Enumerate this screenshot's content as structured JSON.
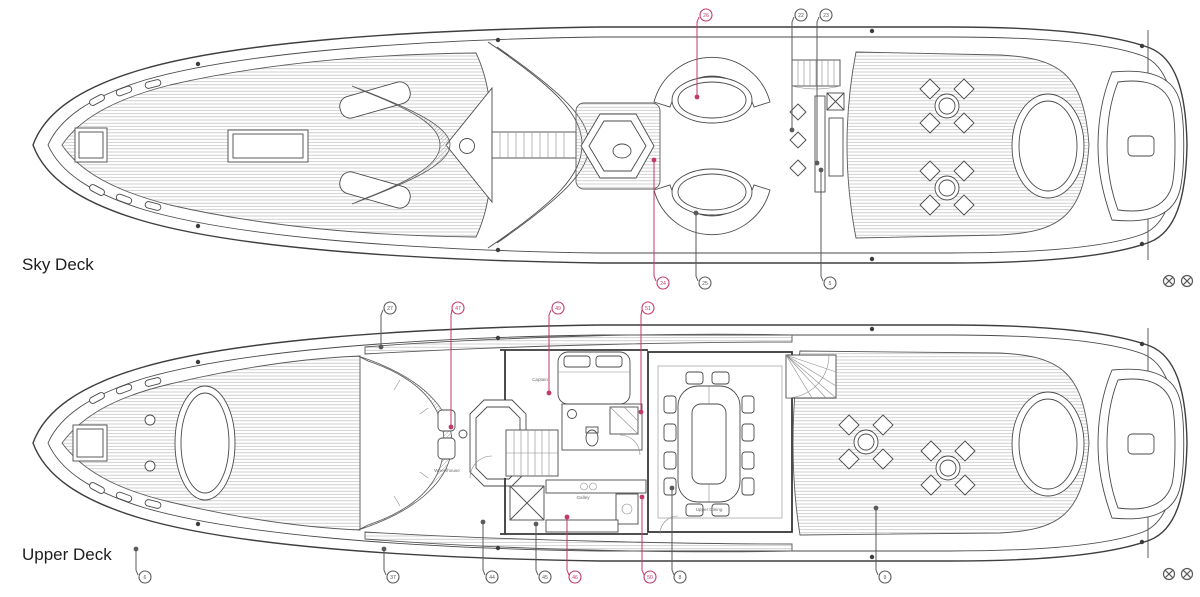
{
  "page": {
    "background": "#ffffff",
    "width": 1200,
    "height": 597
  },
  "colors": {
    "line": "#454545",
    "accent": "#c43a66",
    "callout_gray": "#5a5a5a",
    "deck_label": "#1d1d1d",
    "room_label": "#6a6a6a"
  },
  "decks": {
    "sky": {
      "label": "Sky Deck"
    },
    "upper": {
      "label": "Upper Deck",
      "rooms": {
        "wheelhouse": "Wheelhouse",
        "captain": "Captain",
        "galley": "Galley",
        "dining": "Upper Dining"
      }
    }
  },
  "callouts": [
    {
      "label": "26",
      "color": "red",
      "circle": [
        706,
        15
      ],
      "leader": [
        [
          699,
          17
        ],
        [
          697,
          22
        ],
        [
          697,
          95
        ]
      ],
      "dot": [
        697,
        97
      ]
    },
    {
      "label": "22",
      "color": "gray",
      "circle": [
        801,
        15
      ],
      "leader": [
        [
          794,
          17
        ],
        [
          792,
          22
        ],
        [
          792,
          128
        ]
      ],
      "dot": [
        792,
        130
      ]
    },
    {
      "label": "23",
      "color": "gray",
      "circle": [
        826,
        15
      ],
      "leader": [
        [
          819,
          17
        ],
        [
          817,
          22
        ],
        [
          817,
          161
        ]
      ],
      "dot": [
        817,
        163
      ]
    },
    {
      "label": "24",
      "color": "red",
      "circle": [
        663,
        283
      ],
      "leader": [
        [
          656,
          281
        ],
        [
          654,
          276
        ],
        [
          654,
          162
        ]
      ],
      "dot": [
        654,
        160
      ]
    },
    {
      "label": "25",
      "color": "gray",
      "circle": [
        705,
        283
      ],
      "leader": [
        [
          698,
          281
        ],
        [
          696,
          276
        ],
        [
          696,
          215
        ]
      ],
      "dot": [
        696,
        213
      ]
    },
    {
      "label": "5",
      "color": "gray",
      "circle": [
        830,
        283
      ],
      "leader": [
        [
          823,
          281
        ],
        [
          821,
          276
        ],
        [
          821,
          172
        ]
      ],
      "dot": [
        821,
        170
      ]
    },
    {
      "label": "27",
      "color": "gray",
      "circle": [
        390,
        308
      ],
      "leader": [
        [
          383,
          310
        ],
        [
          381,
          315
        ],
        [
          381,
          345
        ]
      ],
      "dot": [
        381,
        347
      ]
    },
    {
      "label": "47",
      "color": "red",
      "circle": [
        458,
        308
      ],
      "leader": [
        [
          452,
          310
        ],
        [
          451,
          315
        ],
        [
          451,
          425
        ]
      ],
      "dot": [
        451,
        427
      ]
    },
    {
      "label": "49",
      "color": "red",
      "circle": [
        558,
        308
      ],
      "leader": [
        [
          551,
          310
        ],
        [
          549,
          315
        ],
        [
          549,
          391
        ]
      ],
      "dot": [
        549,
        393
      ]
    },
    {
      "label": "51",
      "color": "red",
      "circle": [
        648,
        308
      ],
      "leader": [
        [
          642,
          310
        ],
        [
          641,
          315
        ],
        [
          641,
          410
        ]
      ],
      "dot": [
        641,
        412
      ]
    },
    {
      "label": "6",
      "color": "gray",
      "circle": [
        145,
        577
      ],
      "leader": [
        [
          138,
          575
        ],
        [
          136,
          570
        ],
        [
          136,
          551
        ]
      ],
      "dot": [
        136,
        549
      ]
    },
    {
      "label": "37",
      "color": "gray",
      "circle": [
        393,
        577
      ],
      "leader": [
        [
          386,
          575
        ],
        [
          384,
          570
        ],
        [
          384,
          551
        ]
      ],
      "dot": [
        384,
        549
      ]
    },
    {
      "label": "44",
      "color": "gray",
      "circle": [
        492,
        577
      ],
      "leader": [
        [
          485,
          575
        ],
        [
          483,
          570
        ],
        [
          483,
          524
        ]
      ],
      "dot": [
        483,
        522
      ]
    },
    {
      "label": "45",
      "color": "gray",
      "circle": [
        545,
        577
      ],
      "leader": [
        [
          538,
          575
        ],
        [
          536,
          570
        ],
        [
          536,
          526
        ]
      ],
      "dot": [
        536,
        524
      ]
    },
    {
      "label": "46",
      "color": "red",
      "circle": [
        575,
        577
      ],
      "leader": [
        [
          569,
          575
        ],
        [
          567,
          570
        ],
        [
          567,
          519
        ]
      ],
      "dot": [
        567,
        517
      ]
    },
    {
      "label": "50",
      "color": "red",
      "circle": [
        650,
        577
      ],
      "leader": [
        [
          644,
          575
        ],
        [
          642,
          570
        ],
        [
          642,
          499
        ]
      ],
      "dot": [
        642,
        497
      ]
    },
    {
      "label": "8",
      "color": "gray",
      "circle": [
        680,
        577
      ],
      "leader": [
        [
          674,
          575
        ],
        [
          672,
          570
        ],
        [
          672,
          490
        ]
      ],
      "dot": [
        672,
        488
      ]
    },
    {
      "label": "9",
      "color": "gray",
      "circle": [
        885,
        577
      ],
      "leader": [
        [
          878,
          575
        ],
        [
          876,
          570
        ],
        [
          876,
          510
        ]
      ],
      "dot": [
        876,
        508
      ]
    }
  ],
  "registration_marks": {
    "symbol": "circled-x",
    "positions": [
      [
        1169,
        281
      ],
      [
        1187,
        281
      ],
      [
        1169,
        574
      ],
      [
        1187,
        574
      ]
    ]
  }
}
